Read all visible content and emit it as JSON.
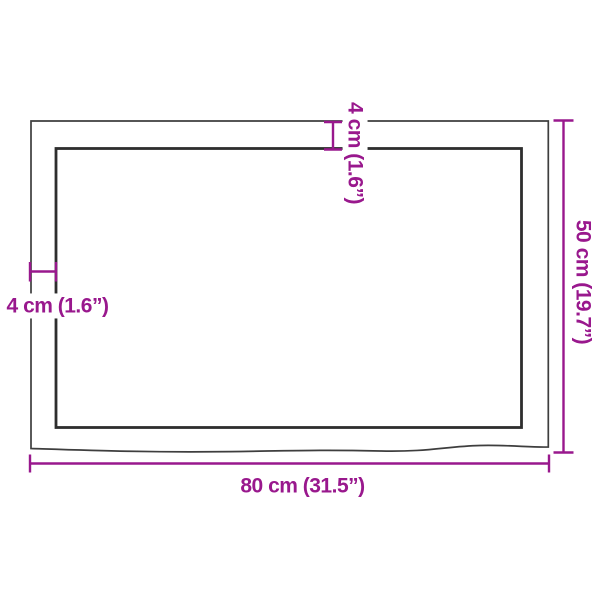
{
  "diagram": {
    "type": "product-dimension-drawing",
    "subject": "rectangular wooden table top with live (wavy) bottom edge, top view with border inset",
    "labels": {
      "width_bottom": "80 cm (31.5”)",
      "height_right": "50 cm (19.7”)",
      "thickness_top": "4 cm (1.6”)",
      "thickness_left": "4 cm (1.6”)"
    },
    "dimensions": {
      "width_cm": 80,
      "width_in": 31.5,
      "height_cm": 50,
      "height_in": 19.7,
      "thickness_cm": 4,
      "thickness_in": 1.6
    },
    "colors": {
      "dimension": "#99188d",
      "outline": "#3e3e3e",
      "inner_outline": "#2e2e2e",
      "background": "#ffffff"
    }
  }
}
